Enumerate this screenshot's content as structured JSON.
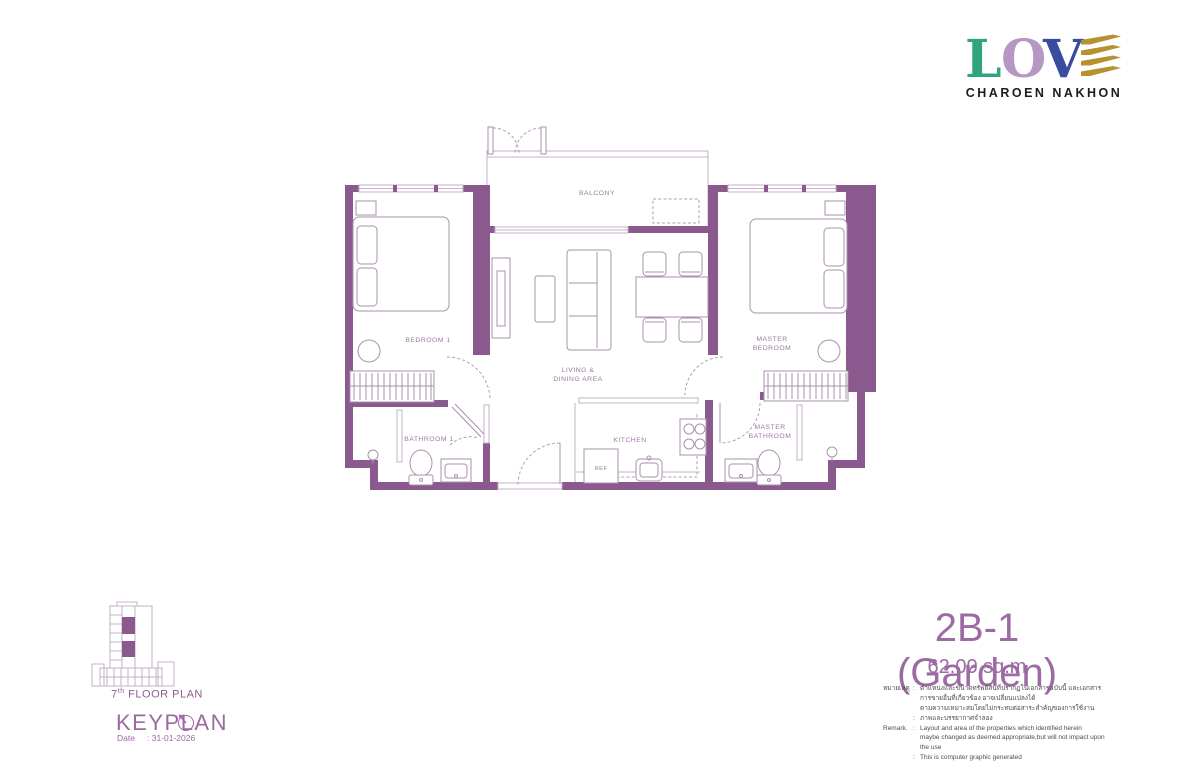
{
  "logo": {
    "letters": [
      {
        "char": "L",
        "color": "#2fa47d"
      },
      {
        "char": "O",
        "color": "#b697c4"
      },
      {
        "char": "V",
        "color": "#3a4c9f"
      }
    ],
    "stripe_color": "#b5922f",
    "brand": "CHAROEN NAKHON"
  },
  "plan": {
    "labels": {
      "balcony": "BALCONY",
      "bedroom1": "BEDROOM 1",
      "living1": "LIVING &",
      "living2": "DINING AREA",
      "master1": "MASTER",
      "master2": "BEDROOM",
      "bathroom1": "BATHROOM 1",
      "kitchen": "KITCHEN",
      "mbath1": "MASTER",
      "mbath2": "BATHROOM",
      "ref": "REF"
    }
  },
  "keyplan": {
    "floor_number": "7",
    "floor_sup": "th",
    "floor_text": "FLOOR PLAN",
    "title": "KEYPLAN",
    "date_label": "Date",
    "date_value": ": 31-01-2026"
  },
  "unit": {
    "name": "2B-1 (Garden)",
    "area": "62.00 sq.m"
  },
  "remark": {
    "rows": [
      {
        "label": "หมายเหตุ",
        "sep": ":",
        "text": "ตำแหน่งและขนาดทรัพย์สินที่ปรากฏในเอกสารฉบับนี้ และเอกสารการขายอื่นที่เกี่ยวข้อง อาจเปลี่ยนแปลงได้"
      },
      {
        "label": "",
        "sep": "",
        "text": "ตามความเหมาะสมโดยไม่กระทบต่อสาระสำคัญของการใช้งาน"
      },
      {
        "label": "",
        "sep": ":",
        "text": "ภาพและบรรยากาศจำลอง"
      },
      {
        "label": "Remark.",
        "sep": ":",
        "text": "Layout and area of the properties which identified herein"
      },
      {
        "label": "",
        "sep": "",
        "text": "maybe changed as deemed appropriate,but will not impact upon the use"
      },
      {
        "label": "",
        "sep": ":",
        "text": "This is computer graphic generated"
      }
    ]
  },
  "colors": {
    "wall": "#8a5a8e",
    "plan_line": "#c6b2c9",
    "fixture_line": "#ab91ae",
    "room_label": "#9d79a1",
    "accent_title": "#9d6ba3"
  }
}
